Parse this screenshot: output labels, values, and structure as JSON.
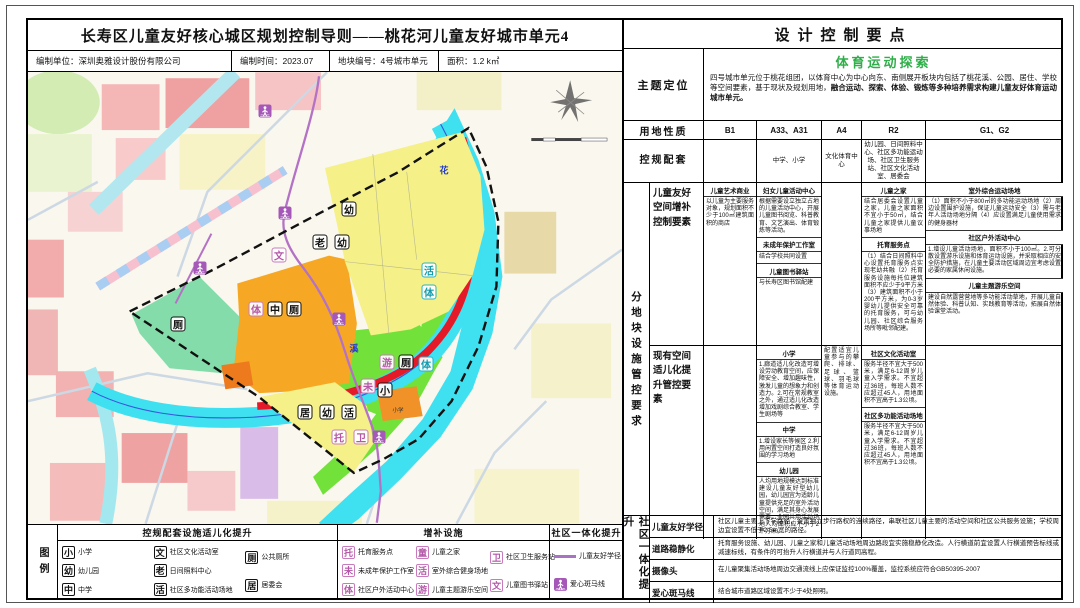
{
  "header": {
    "title": "长寿区儿童友好核心城区规划控制导则——桃花河儿童友好城市单元4",
    "org": "编制单位：深圳奥雅设计股份有限公司",
    "date": "编制时间：2023.07",
    "block_no": "地块编号：4号城市单元",
    "area": "面积：1.2 k㎡"
  },
  "right_panel": {
    "title": "设计控制要点",
    "accent_color": "#2fae49",
    "theme": {
      "label": "主题定位",
      "highlight": "体育运动探索",
      "text1": "四号城市单元位于桃花组团，以体育中心为中心向东、南侧展开板块内包括了桃花溪、公园、居住、学校等空间要素，基于现状及规划用地，",
      "text2": "融合运动、探索、体验、锻炼等多种培养需求构建儿童友好体育运动城市单元。"
    },
    "land_use": {
      "label": "用地性质",
      "cols": [
        "B1",
        "A33、A31",
        "A4",
        "R2",
        "G1、G2"
      ]
    },
    "support": {
      "label": "控规配套",
      "cols": [
        "",
        "中学、小学",
        "文化体育中心",
        "幼儿园、日间照料中心、社区多功能运动场、社区卫生服务站、社区文化活动室、居委会",
        ""
      ]
    },
    "block_control": {
      "outer_label": "分地块设施管控要求",
      "sub1": {
        "label": "儿童友好空间增补控制要素",
        "c1": [
          {
            "h": "儿童艺术商业",
            "t": "以儿童为主要服务对象，规划面积不少于100㎡建筑面积的商店"
          }
        ],
        "c2": [
          {
            "h": "妇女儿童活动中心",
            "t": "根据需要设立独立占地的儿童活动中心，开展儿童图书阅览、科普教育、文艺演出、体育锻炼等活动。"
          },
          {
            "h": "未成年保护工作室",
            "t": "结合学校共同设置"
          },
          {
            "h": "儿童图书驿站",
            "t": "与长寿区图书馆配建"
          }
        ],
        "c3": [],
        "c4": [
          {
            "h": "儿童之家",
            "t": "结合居委会设置儿童之家，儿童之家面积不宜小于50㎡，结合儿童之家提供儿童议事场地"
          },
          {
            "h": "托育服务点",
            "t": "（1）结合日间照料中心设置托育服务点实现老幼共融（2）托育服务设施每托位建筑面积不应少于9平方米（3）建筑面积不小于200平方米，为0-3岁婴幼儿提供安全可靠的托育服务，可与幼儿园、社区综合服务场所等毗邻配建。"
          }
        ],
        "c5": [
          {
            "h": "室外综合运动场地",
            "t": "（1）面积不小于800㎡的多功能运动场地（2）周边设置围护设施，保证儿童运动安全（3）需与老年人活动场地分隔（4）应设置满足儿童使用需求的健身器材"
          },
          {
            "h": "社区户外活动中心",
            "t": "1.增设儿童活动场地，面积不小于100㎡。2.可分散设置游乐设施和体育运动设施，并采取相应的安全防护措施，在儿童主要活动区域周边宜考虑设置必要的家属休闲设施。"
          },
          {
            "h": "儿童主题游乐空间",
            "t": "建设自然露营营地等多功能活动草地，开展儿童自然体验、科普认知、实践教育等活动，拓展自然体验课堂活动。"
          }
        ]
      },
      "sub2": {
        "label": "现有空间适儿化提升管控要素",
        "c1": [],
        "c2": [
          {
            "h": "小学",
            "t": "1.廊道适儿化改造可增设劳动教育空间，应保障安全、增加趣味性，激发儿童的想象力和创造力。2.可在常规教室之外，通过适儿化改造增加戏剧综合教室、学生剧场等"
          },
          {
            "h": "中学",
            "t": "1.增设家长等候区 2.利用闲置空间打造良好氛围的学习场地"
          },
          {
            "h": "幼儿园",
            "t": "人均用地规模达到标准建设儿童友好型幼儿园，幼儿园宜为适龄儿童提供充足的室外活动空间，满足其身心发展需要。全园共用活动场地人均面积应不小于2平方米。"
          }
        ],
        "c3": [
          {
            "h": "",
            "t": "配置适宜儿童参与的攀爬、排球、足球、篮球、羽毛球等体育运动设施。"
          }
        ],
        "c4": [
          {
            "h": "社区文化活动室",
            "t": "服务半径不宜大于500米，满足6-12周岁儿童入学需求。不宜超过36班，每班人数不应超过45人，用地面积不宜高于1.3公顷。"
          },
          {
            "h": "社区多功能活动场地",
            "t": "服务半径不宜大于500米，满足6-12周岁儿童入学需求。不宜超过36班，每班人数不应超过45人，用地面积不宜高于1.3公顷。"
          }
        ],
        "c5": []
      }
    },
    "integration": {
      "outer_label": "社区一体化提升",
      "rows": [
        {
          "label": "儿童友好学径",
          "text": "社区儿童主要上下学路径，设置独立步行路权的连续路径，串联社区儿童主要的活动空间和社区公共服务设施；学校周边宜设置不低于2.5m宽的路径。"
        },
        {
          "label": "道路稳静化",
          "text": "托育服务设施、幼儿园、儿童之家和儿童活动场地周边路段宜实施稳静化改造。人行横道前宜设置人行横道预告标线或减速标线，有条件的可抬升人行横道并与人行道同高程。"
        },
        {
          "label": "摄像头",
          "text": "在儿童聚集活动场地周边交通流线上应保证监控100%覆盖，监控系统应符合GB50395-2007"
        },
        {
          "label": "爱心斑马线",
          "text": "结合城市道路区域设置不少于4处照明。"
        }
      ]
    }
  },
  "legend": {
    "label": "图例",
    "groups": [
      {
        "title": "控规配套设施适儿化提升",
        "style": "std",
        "cols": [
          [
            {
              "g": "小",
              "l": "小学"
            },
            {
              "g": "幼",
              "l": "幼儿园"
            },
            {
              "g": "中",
              "l": "中学"
            }
          ],
          [
            {
              "g": "文",
              "l": "社区文化活动室"
            },
            {
              "g": "老",
              "l": "日间照料中心"
            },
            {
              "g": "活",
              "l": "社区多功能活动场地"
            }
          ],
          [
            {
              "g": "厕",
              "l": "公共厕所"
            },
            {
              "g": "居",
              "l": "居委会"
            }
          ]
        ]
      },
      {
        "title": "增补设施",
        "style": "add",
        "cols": [
          [
            {
              "g": "托",
              "l": "托育服务点"
            },
            {
              "g": "未",
              "l": "未成年保护工作室"
            },
            {
              "g": "体",
              "l": "社区户外活动中心"
            }
          ],
          [
            {
              "g": "童",
              "l": "儿童之家"
            },
            {
              "g": "活",
              "l": "室外综合健身场地"
            },
            {
              "g": "游",
              "l": "儿童主题游乐空间"
            }
          ],
          [
            {
              "g": "卫",
              "l": "社区卫生服务站"
            },
            {
              "g": "文",
              "l": "儿童图书驿站"
            }
          ]
        ]
      },
      {
        "title": "社区一体化提升",
        "style": "integ",
        "cols": [
          [
            {
              "type": "line",
              "l": "儿童友好学径"
            },
            {
              "type": "cross",
              "l": "爱心斑马线"
            }
          ]
        ]
      }
    ]
  },
  "map": {
    "colors": {
      "river": "#3fe0f0",
      "park_green": "#72e23a",
      "residential_yellow": "#f5f088",
      "civic_orange": "#f6a824",
      "green_teal": "#85dcab",
      "red_strip": "#e51a28",
      "route_purple": "#b472c6",
      "boundary": "#111111"
    },
    "markers": [
      {
        "g": "厕",
        "t": "std",
        "x": 150,
        "y": 252
      },
      {
        "g": "体",
        "t": "add",
        "x": 228,
        "y": 237
      },
      {
        "g": "中",
        "t": "std",
        "x": 247,
        "y": 237
      },
      {
        "g": "厕",
        "t": "std",
        "x": 266,
        "y": 237
      },
      {
        "g": "文",
        "t": "add",
        "x": 251,
        "y": 183
      },
      {
        "g": "幼",
        "t": "std",
        "x": 321,
        "y": 137
      },
      {
        "g": "老",
        "t": "std",
        "x": 292,
        "y": 170
      },
      {
        "g": "幼",
        "t": "std",
        "x": 314,
        "y": 170
      },
      {
        "g": "活",
        "t": "teal",
        "x": 401,
        "y": 198
      },
      {
        "g": "体",
        "t": "teal",
        "x": 401,
        "y": 220
      },
      {
        "g": "游",
        "t": "add",
        "x": 359,
        "y": 290
      },
      {
        "g": "厕",
        "t": "std",
        "x": 378,
        "y": 290
      },
      {
        "g": "体",
        "t": "teal",
        "x": 398,
        "y": 292
      },
      {
        "g": "未",
        "t": "add",
        "x": 340,
        "y": 314
      },
      {
        "g": "小",
        "t": "std",
        "x": 357,
        "y": 318
      },
      {
        "g": "居",
        "t": "std",
        "x": 277,
        "y": 340
      },
      {
        "g": "幼",
        "t": "std",
        "x": 299,
        "y": 340
      },
      {
        "g": "活",
        "t": "std",
        "x": 321,
        "y": 340
      },
      {
        "g": "托",
        "t": "add",
        "x": 311,
        "y": 365
      },
      {
        "g": "卫",
        "t": "add",
        "x": 333,
        "y": 365
      }
    ],
    "crossings": [
      {
        "x": 237,
        "y": 39
      },
      {
        "x": 172,
        "y": 196
      },
      {
        "x": 257,
        "y": 141
      },
      {
        "x": 311,
        "y": 247
      },
      {
        "x": 351,
        "y": 365
      }
    ],
    "labels": [
      {
        "t": "花",
        "x": 416,
        "y": 98,
        "c": "river"
      },
      {
        "t": "溪",
        "x": 326,
        "y": 276,
        "c": "river"
      },
      {
        "t": "小学",
        "x": 370,
        "y": 338,
        "c": "tiny"
      }
    ]
  }
}
